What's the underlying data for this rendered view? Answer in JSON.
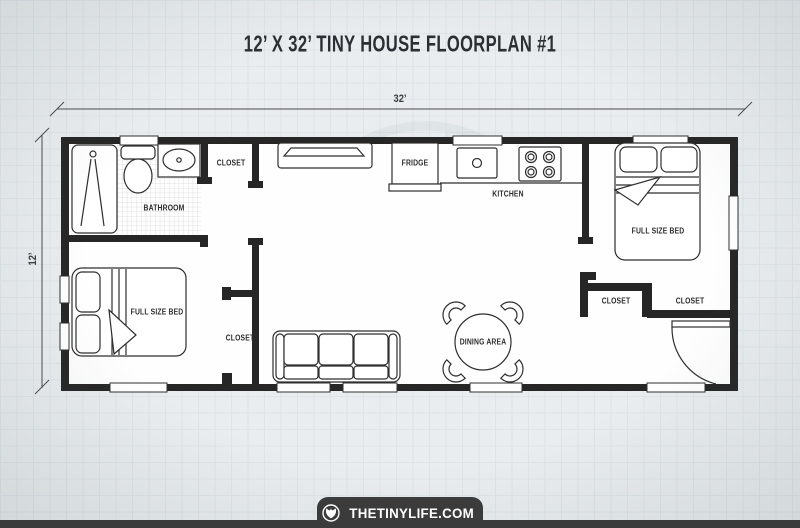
{
  "title": "12’ X 32’ TINY HOUSE FLOORPLAN #1",
  "dimensions": {
    "width": "32’",
    "height": "12’"
  },
  "rooms": {
    "bathroom": "BATHROOM",
    "hall_closet": "CLOSET",
    "kitchen": "KITCHEN",
    "fridge": "FRIDGE",
    "dining": "DINING AREA",
    "bedroom_right_bed": "FULL SIZE BED",
    "bedroom_right_closet_left": "CLOSET",
    "bedroom_right_closet_right": "CLOSET",
    "bedroom_left_bed": "FULL SIZE BED",
    "bedroom_left_closet": "CLOSET"
  },
  "footer": {
    "site": "THETINYLIFE.COM",
    "logo_icon": "tinylife-tulip-logo"
  },
  "colors": {
    "paper": "#e9edef",
    "grid_line": "#dee4e8",
    "wall": "#262626",
    "furniture_line": "#2e2e2e",
    "footer_bar": "#3b3b3b",
    "text": "#2b2b2b"
  }
}
